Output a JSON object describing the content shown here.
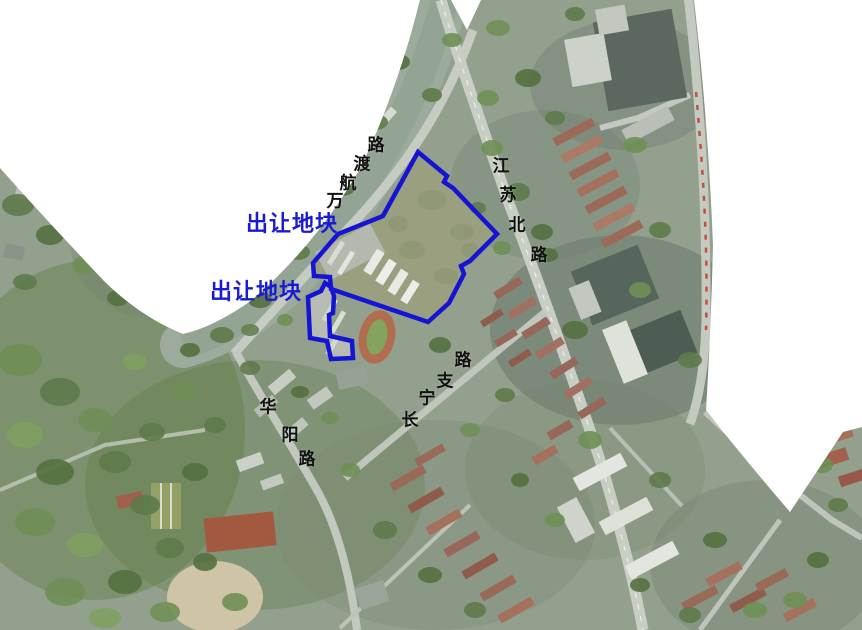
{
  "map": {
    "parcel_labels": [
      {
        "text": "出让地块"
      },
      {
        "text": "出让地块"
      }
    ],
    "road_labels": [
      {
        "name": "wanhangdu-road",
        "text": "万航渡路",
        "chars": [
          "万",
          "航",
          "渡",
          "路"
        ]
      },
      {
        "name": "jiangsu-north-road",
        "text": "江苏北路",
        "chars": [
          "江",
          "苏",
          "北",
          "路"
        ]
      },
      {
        "name": "changning-branch-road",
        "text": "长宁支路",
        "chars": [
          "长",
          "宁",
          "支",
          "路"
        ]
      },
      {
        "name": "huayang-road",
        "text": "华阳路",
        "chars": [
          "华",
          "阳",
          "路"
        ]
      }
    ],
    "colors": {
      "parcel_outline": "#1414d2",
      "parcel_label": "#1a1ad0",
      "road_label": "#111111",
      "mask": "#ffffff"
    }
  }
}
